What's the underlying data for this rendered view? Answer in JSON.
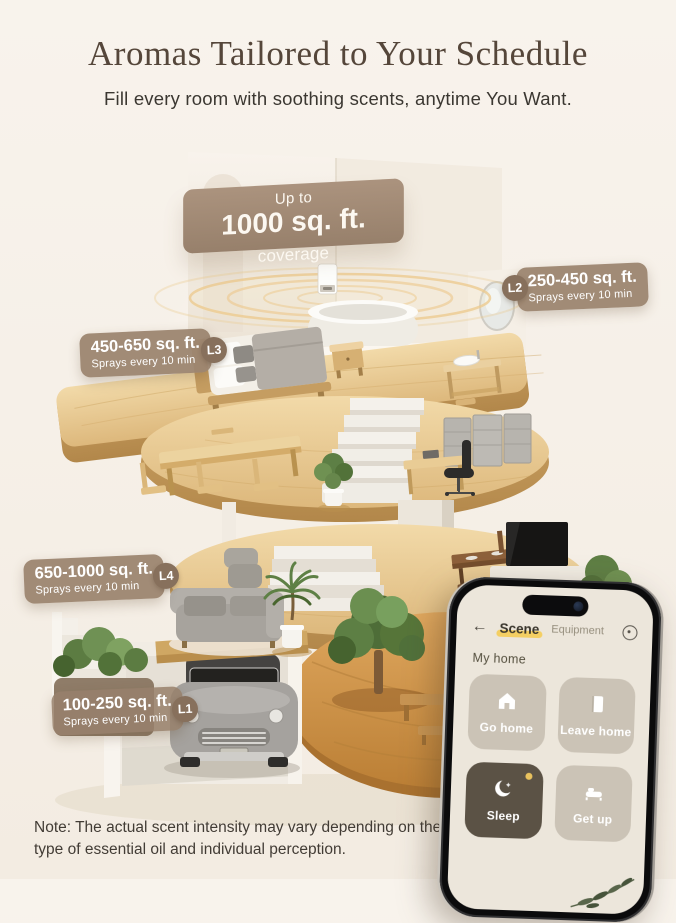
{
  "header": {
    "title": "Aromas Tailored to Your Schedule",
    "subtitle": "Fill every room with soothing scents, anytime You Want."
  },
  "coverage_badge": {
    "top_line": "Up to",
    "value": "1000 sq. ft.",
    "suffix": " coverage"
  },
  "level_labels": [
    {
      "id": "L2",
      "area": "250-450 sq. ft.",
      "frequency": "Sprays every 10 min"
    },
    {
      "id": "L3",
      "area": "450-650 sq. ft.",
      "frequency": "Sprays every 10 min"
    },
    {
      "id": "L4",
      "area": "650-1000 sq. ft.",
      "frequency": "Sprays every 10 min"
    },
    {
      "id": "L1",
      "area": "100-250 sq. ft.",
      "frequency": "Sprays every 10 min"
    }
  ],
  "phone_app": {
    "back_icon": "←",
    "tabs": [
      {
        "label": "Scene",
        "active": true
      },
      {
        "label": "Equipment",
        "active": false
      }
    ],
    "settings_icon": "dial-icon",
    "section_title": "My home",
    "scene_buttons": [
      {
        "label": "Go home",
        "icon": "home-icon",
        "style": "light"
      },
      {
        "label": "Leave home",
        "icon": "door-icon",
        "style": "light"
      },
      {
        "label": "Sleep",
        "icon": "moon-icon",
        "style": "dark"
      },
      {
        "label": "Get up",
        "icon": "bed-icon",
        "style": "light"
      }
    ]
  },
  "footer_note": "Note: The actual scent intensity may vary depending on the type of essential oil and individual perception.",
  "colors": {
    "background": "#F6F0E8",
    "label_taupe": "#9C8572",
    "label_circle": "#87705C",
    "tab_highlight": "#F4CF63",
    "sleep_button": "#5B5245",
    "light_button": "#CBC3B6",
    "wood": "#E2BE82"
  }
}
